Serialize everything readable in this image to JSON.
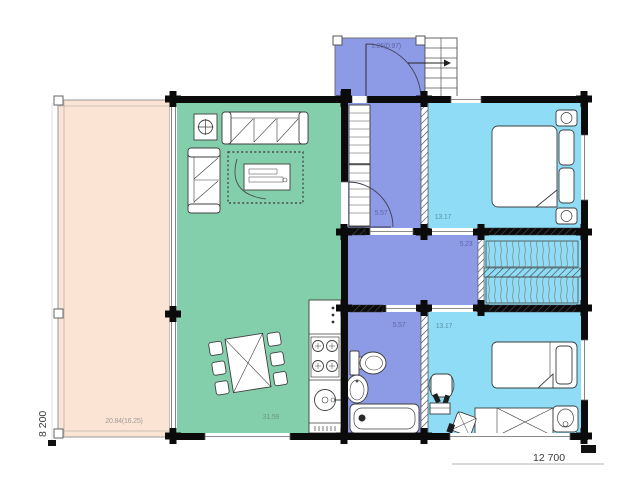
{
  "colors": {
    "terrace": "#fbe4d4",
    "living": "#83ceab",
    "hall": "#8d9ae6",
    "bedroom": "#8edcf5",
    "wall": "#0b0b0b"
  },
  "rooms": {
    "terrace": {
      "area_label": "20.84(16.25)"
    },
    "living_room": {
      "area_label": "31.59"
    },
    "entry_porch": {
      "area_label": "1.26(0.97)"
    },
    "hallway": {
      "area_label": "5.57"
    },
    "corridor": {
      "area_label": "5.23"
    },
    "bathroom": {
      "area_label": "5.57"
    },
    "bedroom_top": {
      "area_label": "13.17"
    },
    "bedroom_bottom": {
      "area_label": "13.17"
    }
  },
  "dimensions": {
    "height_label": "8 200",
    "width_label": "12 700"
  }
}
